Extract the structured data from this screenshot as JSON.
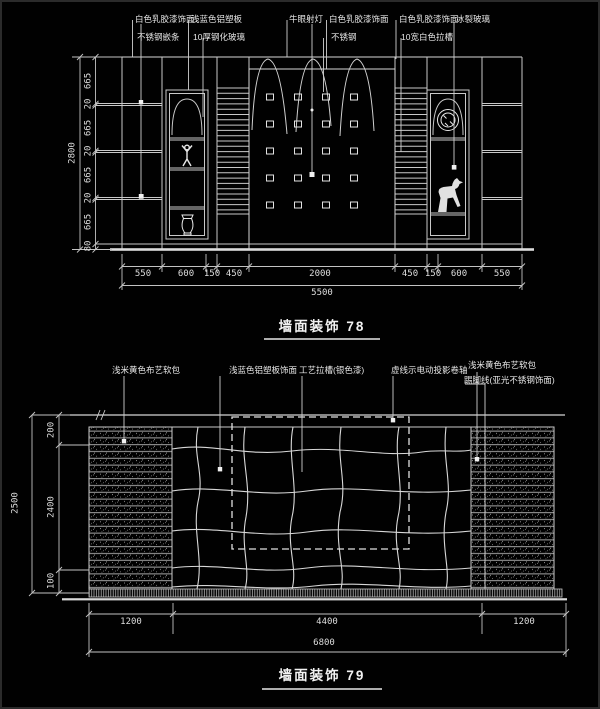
{
  "colors": {
    "background": "#010101",
    "line": "#c9c9c9",
    "bright_line": "#e8e8e8",
    "text": "#e6e6e6"
  },
  "drawing_78": {
    "title": "墙面装饰 78",
    "callouts": [
      "白色乳胶漆饰面",
      "浅蓝色铝塑板",
      "不锈钢嵌条",
      "10厚钢化玻璃",
      "牛眼射灯",
      "白色乳胶漆饰面",
      "不锈钢",
      "白色乳胶漆饰面",
      "冰裂玻璃",
      "10宽白色拉槽"
    ],
    "dims_bottom": [
      "550",
      "600",
      "150",
      "450",
      "2000",
      "450",
      "150",
      "600",
      "550"
    ],
    "dim_total_bottom": "5500",
    "dims_left": [
      "665",
      "20",
      "665",
      "20",
      "665",
      "20",
      "665",
      "80"
    ],
    "dim_total_left": "2800"
  },
  "drawing_79": {
    "title": "墙面装饰 79",
    "callouts": [
      "浅米黄色布艺软包",
      "浅蓝色铝塑板饰面",
      "工艺拉槽(银色漆)",
      "虚线示电动投影卷轴",
      "浅米黄色布艺软包",
      "踢脚线(亚光不锈钢饰面)"
    ],
    "dims_bottom": [
      "1200",
      "4400",
      "1200"
    ],
    "dim_total_bottom": "6800",
    "dims_left": [
      "200",
      "2400",
      "100"
    ],
    "dim_total_left": "2500"
  }
}
